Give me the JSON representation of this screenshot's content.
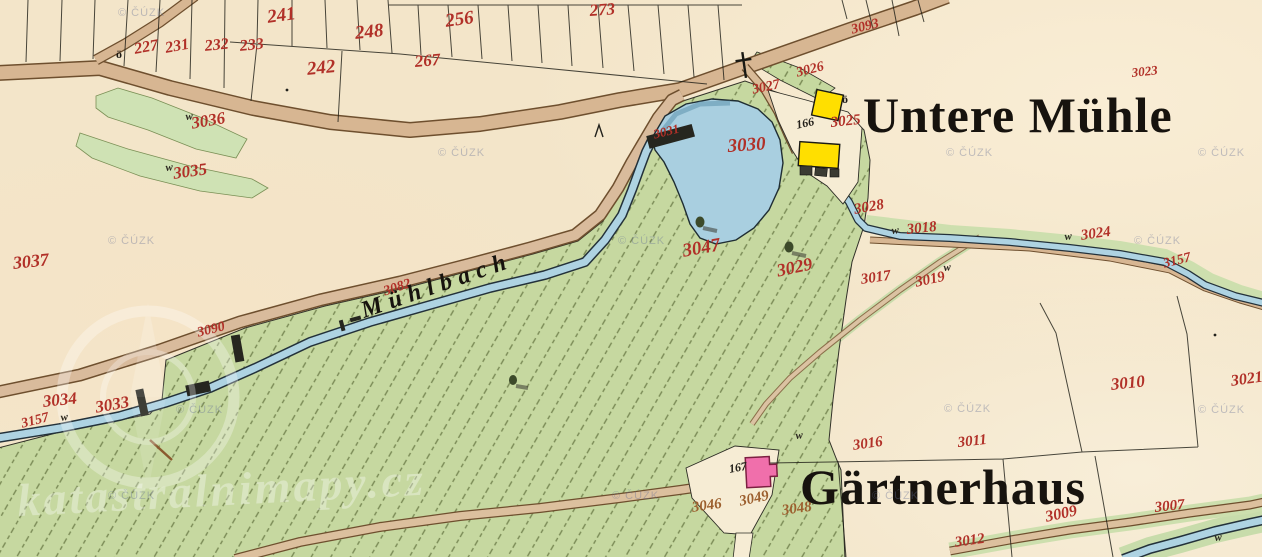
{
  "map": {
    "watermark_text": "© ČÚZK",
    "ghost_watermark": "katastralnimapy.cz",
    "colors": {
      "paper": "#f3e5c9",
      "road_fill": "#d7b692",
      "meadow_green": "#c5d89f",
      "pond_blue": "#a9cfe0",
      "building_yellow": "#ffdf00",
      "building_pink": "#f06fab",
      "parcel_number_red": "#b13028",
      "big_label_black": "#17130e"
    }
  },
  "labels": [
    {
      "t": "227",
      "x": 133,
      "y": 42,
      "r": -10,
      "s": 16
    },
    {
      "t": "231",
      "x": 164,
      "y": 41,
      "r": -10,
      "s": 16
    },
    {
      "t": "232",
      "x": 204,
      "y": 39,
      "r": -6,
      "s": 16
    },
    {
      "t": "233",
      "x": 239,
      "y": 39,
      "r": -6,
      "s": 16
    },
    {
      "t": "241",
      "x": 266,
      "y": 8,
      "r": -8,
      "s": 19
    },
    {
      "t": "248",
      "x": 354,
      "y": 24,
      "r": -6,
      "s": 19
    },
    {
      "t": "242",
      "x": 306,
      "y": 60,
      "r": -6,
      "s": 19
    },
    {
      "t": "256",
      "x": 444,
      "y": 12,
      "r": -8,
      "s": 19
    },
    {
      "t": "267",
      "x": 414,
      "y": 53,
      "r": -5,
      "s": 17
    },
    {
      "t": "273",
      "x": 589,
      "y": 2,
      "r": -4,
      "s": 17
    },
    {
      "t": "3093",
      "x": 850,
      "y": 24,
      "r": -14,
      "s": 14
    },
    {
      "t": "3023",
      "x": 1131,
      "y": 66,
      "r": -6,
      "s": 13
    },
    {
      "t": "3027",
      "x": 751,
      "y": 84,
      "r": -12,
      "s": 14
    },
    {
      "t": "3026",
      "x": 795,
      "y": 67,
      "r": -14,
      "s": 14
    },
    {
      "t": "3025",
      "x": 830,
      "y": 116,
      "r": -6,
      "s": 15
    },
    {
      "t": "166",
      "x": 795,
      "y": 119,
      "r": -12,
      "c": "blacknum",
      "n": "house-number-166"
    },
    {
      "t": "3030",
      "x": 727,
      "y": 137,
      "r": -4,
      "s": 19
    },
    {
      "t": "3031",
      "x": 652,
      "y": 128,
      "r": -14,
      "s": 13
    },
    {
      "t": "3036",
      "x": 190,
      "y": 115,
      "r": -10,
      "s": 17
    },
    {
      "t": "3035",
      "x": 172,
      "y": 165,
      "r": -8,
      "s": 17
    },
    {
      "t": "3037",
      "x": 12,
      "y": 254,
      "r": -6,
      "s": 18
    },
    {
      "t": "3082",
      "x": 382,
      "y": 286,
      "r": -18,
      "s": 14
    },
    {
      "t": "3090",
      "x": 196,
      "y": 327,
      "r": -14,
      "s": 14
    },
    {
      "t": "3047",
      "x": 681,
      "y": 242,
      "r": -10,
      "s": 19
    },
    {
      "t": "3029",
      "x": 775,
      "y": 262,
      "r": -12,
      "s": 18
    },
    {
      "t": "3028",
      "x": 853,
      "y": 203,
      "r": -10,
      "s": 15
    },
    {
      "t": "w",
      "x": 891,
      "y": 226,
      "r": -6,
      "c": "wsym"
    },
    {
      "t": "3018",
      "x": 906,
      "y": 223,
      "r": -6,
      "s": 15
    },
    {
      "t": "3017",
      "x": 860,
      "y": 273,
      "r": -8,
      "s": 15
    },
    {
      "t": "3019",
      "x": 914,
      "y": 276,
      "r": -12,
      "s": 15
    },
    {
      "t": "w",
      "x": 943,
      "y": 263,
      "r": -6,
      "c": "wsym"
    },
    {
      "t": "w",
      "x": 1064,
      "y": 232,
      "r": -6,
      "c": "wsym"
    },
    {
      "t": "3024",
      "x": 1080,
      "y": 229,
      "r": -8,
      "s": 15
    },
    {
      "t": "3157",
      "x": 1162,
      "y": 258,
      "r": -14,
      "s": 14
    },
    {
      "t": "3034",
      "x": 42,
      "y": 393,
      "r": -6,
      "s": 17
    },
    {
      "t": "3033",
      "x": 94,
      "y": 399,
      "r": -10,
      "s": 17
    },
    {
      "t": "3157",
      "x": 20,
      "y": 418,
      "r": -14,
      "s": 14
    },
    {
      "t": "w",
      "x": 60,
      "y": 413,
      "r": -8,
      "c": "wsym"
    },
    {
      "t": "3021",
      "x": 1230,
      "y": 374,
      "r": -8,
      "s": 16
    },
    {
      "t": "3010",
      "x": 1110,
      "y": 376,
      "r": -6,
      "s": 17
    },
    {
      "t": "3011",
      "x": 957,
      "y": 436,
      "r": -6,
      "s": 15
    },
    {
      "t": "w",
      "x": 795,
      "y": 431,
      "r": -6,
      "c": "wsym"
    },
    {
      "t": "3016",
      "x": 852,
      "y": 439,
      "r": -8,
      "s": 15
    },
    {
      "t": "167",
      "x": 728,
      "y": 463,
      "r": -10,
      "c": "blacknum",
      "n": "house-number-167"
    },
    {
      "t": "3046",
      "x": 691,
      "y": 501,
      "r": -8,
      "s": 15,
      "c": "brown"
    },
    {
      "t": "3049",
      "x": 738,
      "y": 495,
      "r": -12,
      "s": 15,
      "c": "brown"
    },
    {
      "t": "3048",
      "x": 781,
      "y": 504,
      "r": -8,
      "s": 15,
      "c": "brown"
    },
    {
      "t": "3009",
      "x": 1044,
      "y": 510,
      "r": -12,
      "s": 16
    },
    {
      "t": "3007",
      "x": 1154,
      "y": 501,
      "r": -6,
      "s": 15
    },
    {
      "t": "3012",
      "x": 954,
      "y": 536,
      "r": -8,
      "s": 15
    },
    {
      "t": "ö",
      "x": 116,
      "y": 48,
      "r": 0,
      "c": "sym",
      "n": "oe-symbol"
    },
    {
      "t": "ö",
      "x": 842,
      "y": 93,
      "r": 0,
      "c": "sym",
      "n": "oe-symbol"
    },
    {
      "t": "w",
      "x": 185,
      "y": 112,
      "r": -6,
      "c": "wsym"
    },
    {
      "t": "w",
      "x": 165,
      "y": 163,
      "r": -6,
      "c": "wsym"
    },
    {
      "t": "w",
      "x": 1214,
      "y": 533,
      "r": -6,
      "c": "wsym"
    },
    {
      "t": "Untere Mühle",
      "x": 863,
      "y": 90,
      "r": 0,
      "c": "place",
      "n": "place-label-untere-muehle"
    },
    {
      "t": "Gärtnerhaus",
      "x": 800,
      "y": 462,
      "r": 0,
      "c": "place",
      "n": "place-label-gaertnerhaus"
    },
    {
      "t": "Mühlbach",
      "x": 358,
      "y": 300,
      "r": -19,
      "c": "stream-name",
      "n": "stream-label-muehlbach"
    }
  ],
  "watermarks": [
    [
      118,
      8
    ],
    [
      438,
      148
    ],
    [
      946,
      148
    ],
    [
      1198,
      148
    ],
    [
      108,
      236
    ],
    [
      618,
      236
    ],
    [
      1134,
      236
    ],
    [
      176,
      405
    ],
    [
      944,
      404
    ],
    [
      1198,
      405
    ],
    [
      108,
      491
    ],
    [
      612,
      491
    ],
    [
      872,
      491
    ]
  ]
}
